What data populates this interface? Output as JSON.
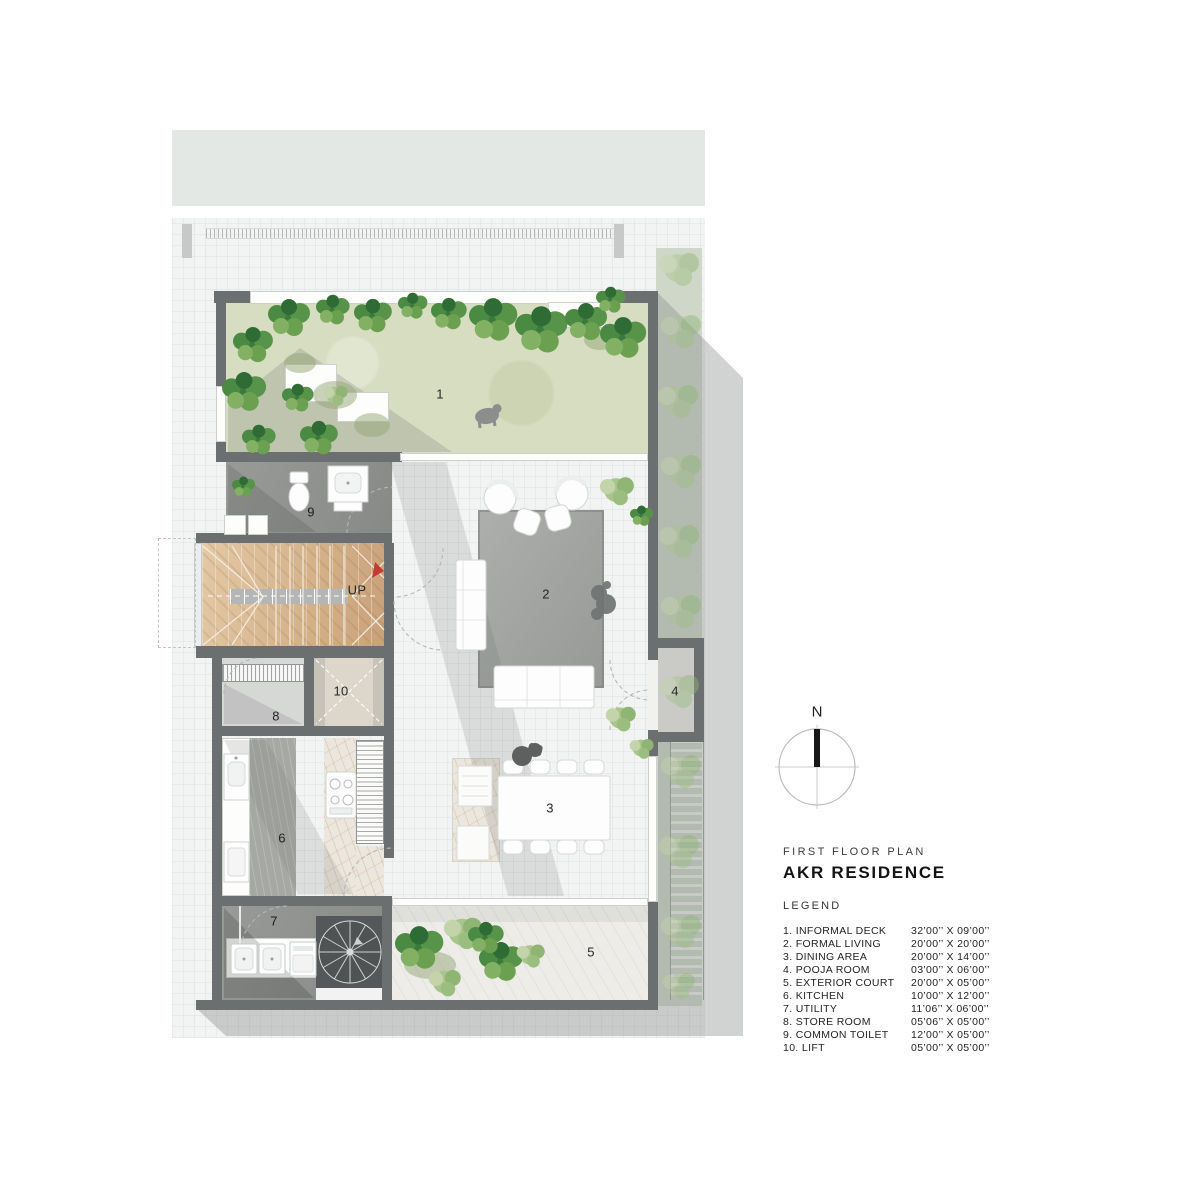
{
  "sheet": {
    "north_label": "N",
    "plan_title": "FIRST FLOOR PLAN",
    "project_name": "AKR RESIDENCE",
    "legend_title": "LEGEND",
    "stair_direction_label": "UP",
    "room_numbers": {
      "informal_deck": "1",
      "formal_living": "2",
      "dining_area": "3",
      "pooja_room": "4",
      "exterior_court": "5",
      "kitchen": "6",
      "utility": "7",
      "store_room": "8",
      "common_toilet": "9",
      "lift": "10"
    },
    "legend": [
      {
        "label": "1. INFORMAL DECK",
        "dim": "32’00’’ X 09’00’’"
      },
      {
        "label": "2. FORMAL LIVING",
        "dim": "20’00’’ X 20’00’’"
      },
      {
        "label": "3. DINING AREA",
        "dim": "20’00’’ X 14’00’’"
      },
      {
        "label": "4. POOJA ROOM",
        "dim": "03’00’’ X 06’00’’"
      },
      {
        "label": "5. EXTERIOR COURT",
        "dim": "20’00’’ X 05’00’’"
      },
      {
        "label": "6. KITCHEN",
        "dim": "10’00’’ X 12’00’’"
      },
      {
        "label": "7. UTILITY",
        "dim": "11’06’’ X 06’00’’"
      },
      {
        "label": "8. STORE ROOM",
        "dim": "05’06’’ X 05’00’’"
      },
      {
        "label": "9. COMMON TOILET",
        "dim": "12’00’’ X 05’00’’"
      },
      {
        "label": "10. LIFT",
        "dim": "05’00’’ X 05’00’’"
      }
    ],
    "colors": {
      "wall_gray": "#6c6f70",
      "lawn_green": "#d7ddc1",
      "wood": "#d5b48c",
      "accent_red": "#c43b36"
    }
  }
}
